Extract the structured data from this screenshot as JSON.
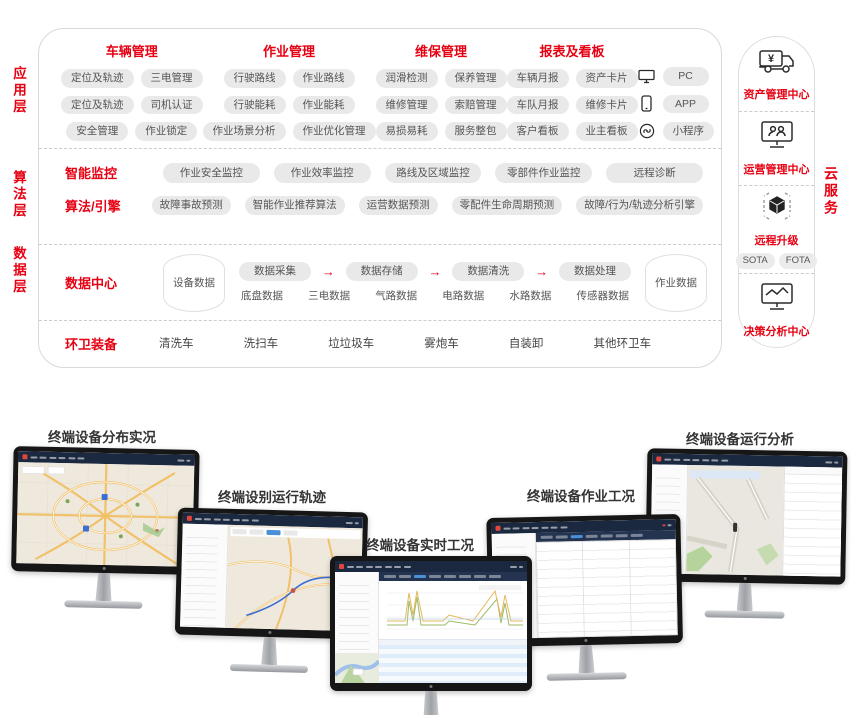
{
  "colors": {
    "accent_red": "#e60012",
    "chip_bg": "#e9e9e9",
    "panel_border": "#d9d9d9",
    "screen_header_navy": "#1b2940"
  },
  "diagram": {
    "layer_labels": {
      "app": "应用层",
      "algo": "算法层",
      "data": "数据层"
    },
    "app": {
      "groups": [
        {
          "title": "车辆管理",
          "rows": [
            [
              "定位及轨迹",
              "三电管理"
            ],
            [
              "定位及轨迹",
              "司机认证"
            ],
            [
              "安全管理",
              "作业锁定"
            ]
          ]
        },
        {
          "title": "作业管理",
          "rows": [
            [
              "行驶路线",
              "作业路线"
            ],
            [
              "行驶能耗",
              "作业能耗"
            ],
            [
              "作业场景分析",
              "作业优化管理"
            ]
          ]
        },
        {
          "title": "维保管理",
          "rows": [
            [
              "润滑检测",
              "保养管理"
            ],
            [
              "维修管理",
              "索赔管理"
            ],
            [
              "易损易耗",
              "服务整包"
            ]
          ]
        },
        {
          "title": "报表及看板",
          "rows": [
            [
              "车辆月报",
              "资产卡片"
            ],
            [
              "车队月报",
              "维修卡片"
            ],
            [
              "客户看板",
              "业主看板"
            ]
          ]
        }
      ],
      "devices": [
        {
          "icon": "pc-icon",
          "label": "PC"
        },
        {
          "icon": "phone-icon",
          "label": "APP"
        },
        {
          "icon": "mini-program-icon",
          "label": "小程序"
        }
      ]
    },
    "algo": {
      "rows": [
        {
          "title": "智能监控",
          "chips": [
            "作业安全监控",
            "作业效率监控",
            "路线及区域监控",
            "零部件作业监控",
            "远程诊断"
          ]
        },
        {
          "title": "算法/引擎",
          "chips": [
            "故障事故预测",
            "智能作业推荐算法",
            "运营数据预测",
            "零配件生命周期预测",
            "故障/行为/轨迹分析引擎"
          ]
        }
      ]
    },
    "data_center": {
      "title": "数据中心",
      "device_db": "设备数据",
      "flow": [
        "数据采集",
        "数据存储",
        "数据清洗",
        "数据处理"
      ],
      "arrow_icon": "→",
      "sources": [
        "底盘数据",
        "三电数据",
        "气路数据",
        "电路数据",
        "水路数据",
        "传感器数据"
      ],
      "job_db": "作业数据"
    },
    "equipment": {
      "title": "环卫装备",
      "items": [
        "清洗车",
        "洗扫车",
        "垃垃圾车",
        "雾炮车",
        "自装卸",
        "其他环卫车"
      ]
    },
    "cloud": {
      "vertical_label": "云服务",
      "sections": [
        {
          "icon": "asset-truck-icon",
          "label": "资产管理中心"
        },
        {
          "icon": "operation-monitor-icon",
          "label": "运营管理中心"
        },
        {
          "icon": "ota-cube-icon",
          "label": "远程升级",
          "chips": [
            "SOTA",
            "FOTA"
          ]
        },
        {
          "icon": "analysis-monitor-icon",
          "label": "决策分析中心"
        }
      ]
    }
  },
  "monitors": [
    {
      "label": "终端设备分布实况"
    },
    {
      "label": "终端设别运行轨迹"
    },
    {
      "label": "终端设备实时工况"
    },
    {
      "label": "终端设备作业工况"
    },
    {
      "label": "终端设备运行分析"
    }
  ]
}
